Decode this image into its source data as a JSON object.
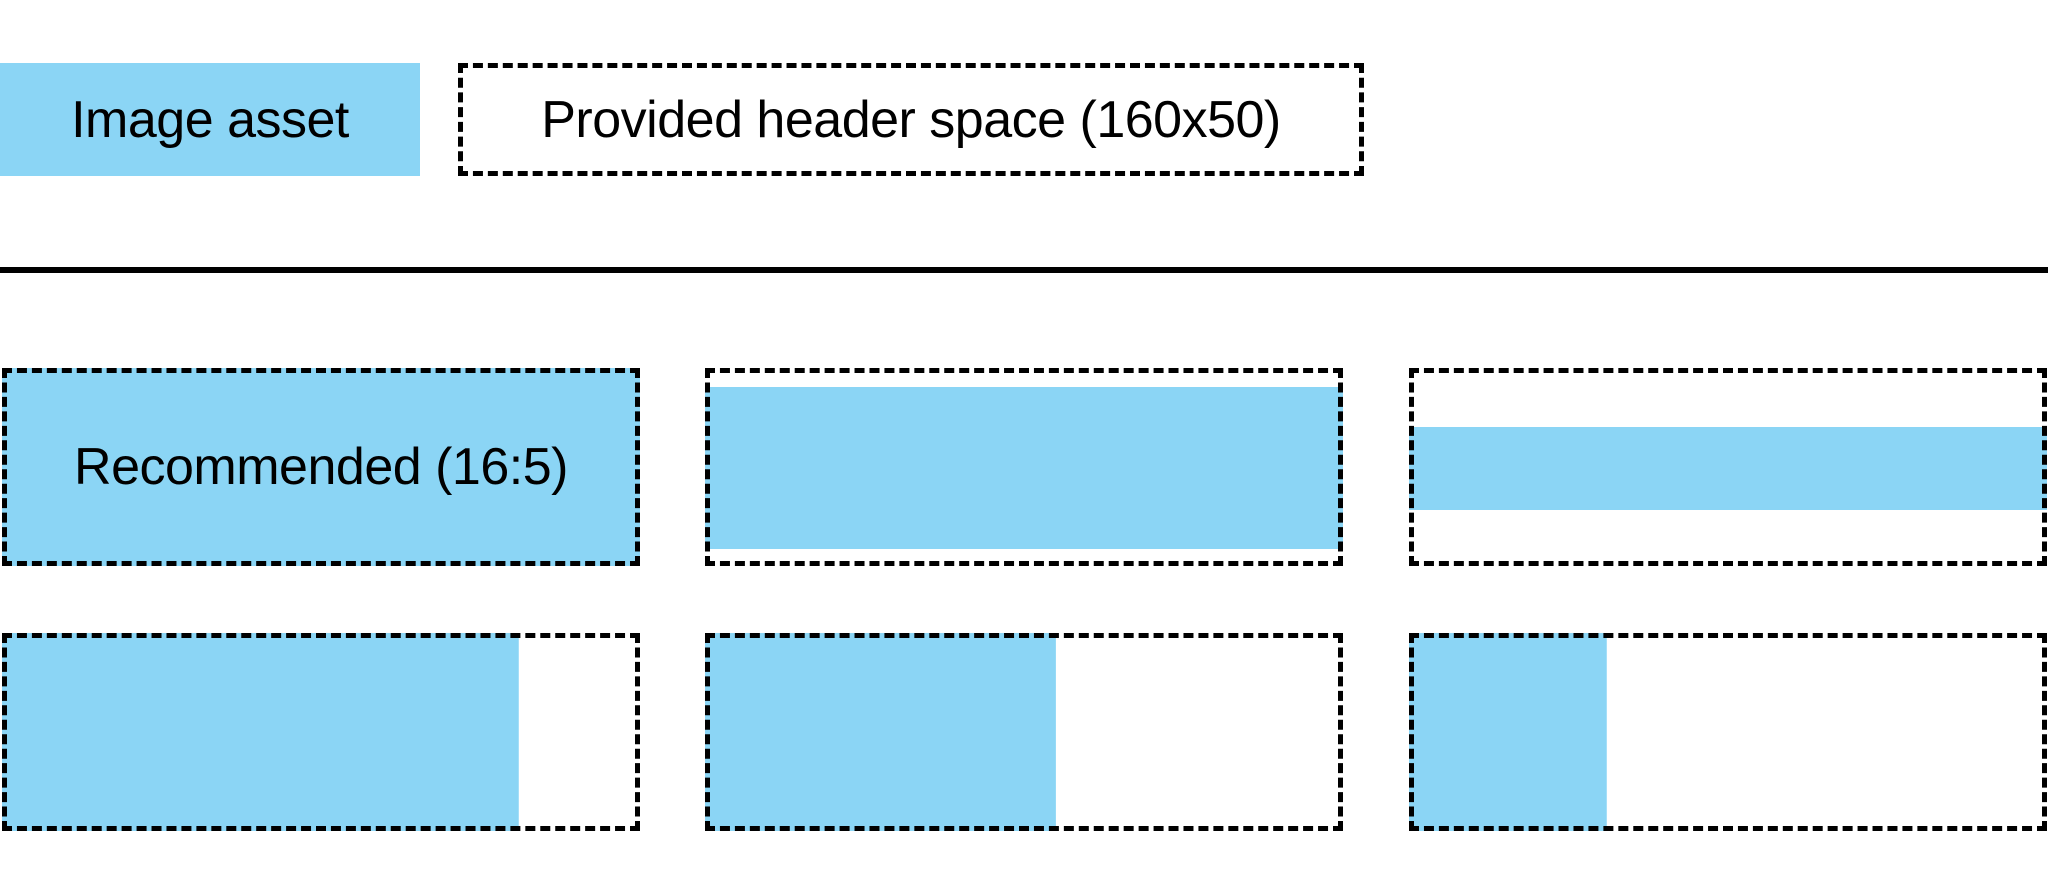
{
  "canvas": {
    "background": "#ffffff"
  },
  "palette": {
    "asset_blue": "#8bd5f5",
    "ink": "#000000"
  },
  "legend": {
    "image_asset": {
      "label": "Image asset"
    },
    "header_space": {
      "label": "Provided header space (160x50)"
    }
  },
  "examples": {
    "recommended_aspect": "16:5",
    "cells": [
      {
        "name": "recommended-16-5",
        "label": "Recommended (16:5)",
        "fill": {
          "x": "0px",
          "top": "0px",
          "width": "100%",
          "height": "100%"
        }
      },
      {
        "name": "full-width-slight-letterbox",
        "label": "",
        "fill": {
          "x": "0px",
          "top": "19px",
          "width": "100%",
          "height": "calc(100% - 36px)"
        }
      },
      {
        "name": "full-width-deep-letterbox",
        "label": "",
        "fill": {
          "x": "0px",
          "top": "59px",
          "width": "100%",
          "height": "83px"
        }
      },
      {
        "name": "full-height-81pct-width",
        "label": "",
        "fill": {
          "x": "0px",
          "top": "0px",
          "width": "81%",
          "height": "100%"
        }
      },
      {
        "name": "full-height-55pct-width",
        "label": "",
        "fill": {
          "x": "0px",
          "top": "0px",
          "width": "55%",
          "height": "100%"
        }
      },
      {
        "name": "full-height-31pct-width",
        "label": "",
        "fill": {
          "x": "0px",
          "top": "0px",
          "width": "31%",
          "height": "100%"
        }
      }
    ]
  }
}
